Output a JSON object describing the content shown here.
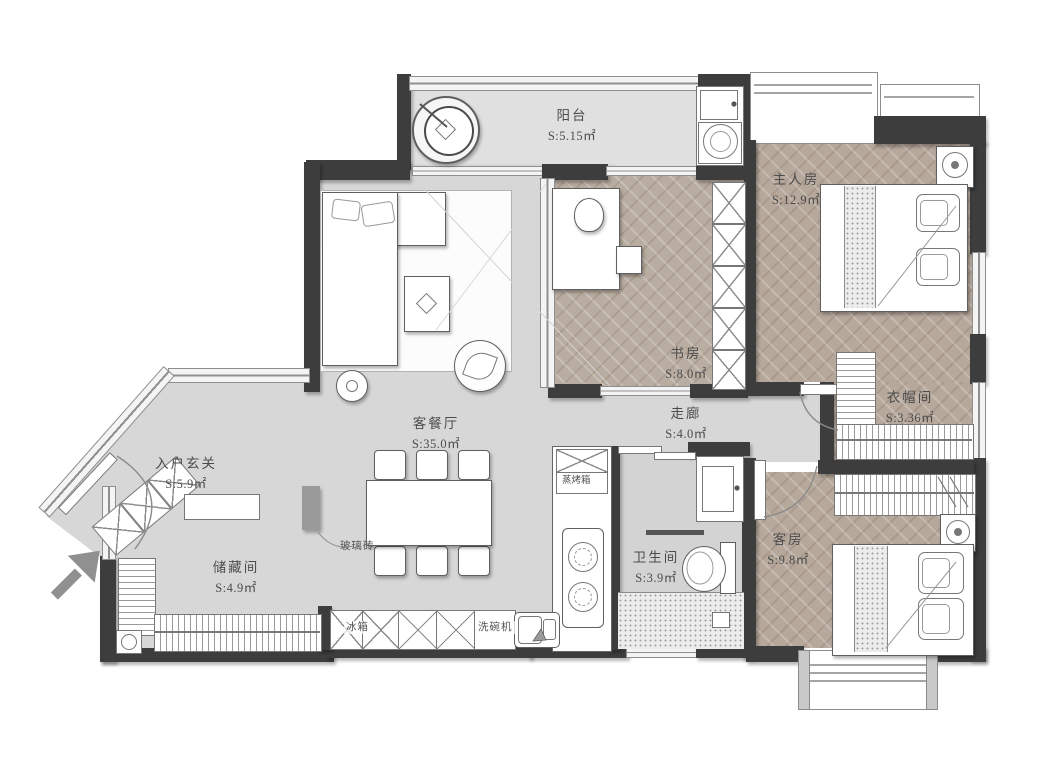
{
  "rooms": [
    {
      "id": "balcony",
      "name": "阳台",
      "area": "S:5.15㎡"
    },
    {
      "id": "master-bedroom",
      "name": "主人房",
      "area": "S:12.9㎡"
    },
    {
      "id": "study",
      "name": "书房",
      "area": "S:8.0㎡"
    },
    {
      "id": "corridor",
      "name": "走廊",
      "area": "S:4.0㎡"
    },
    {
      "id": "cloakroom",
      "name": "衣帽间",
      "area": "S:3.36㎡"
    },
    {
      "id": "entry-foyer",
      "name": "入户玄关",
      "area": "S:5.9㎡"
    },
    {
      "id": "living-dining",
      "name": "客餐厅",
      "area": "S:35.0㎡"
    },
    {
      "id": "storage",
      "name": "储藏间",
      "area": "S:4.9㎡"
    },
    {
      "id": "bathroom",
      "name": "卫生间",
      "area": "S:3.9㎡"
    },
    {
      "id": "guest-room",
      "name": "客房",
      "area": "S:9.8㎡"
    }
  ],
  "fixtures": {
    "steam_oven": "蒸烤箱",
    "glass_brick": "玻璃砖",
    "fridge": "冰箱",
    "dishwasher": "洗碗机"
  },
  "colors": {
    "wall": "#3d3d3d",
    "wood_floor": "#b6a89b",
    "tile_floor": "#d7d7d7",
    "window": "#f4f4f4",
    "furniture_outline": "#5f5f5f"
  }
}
